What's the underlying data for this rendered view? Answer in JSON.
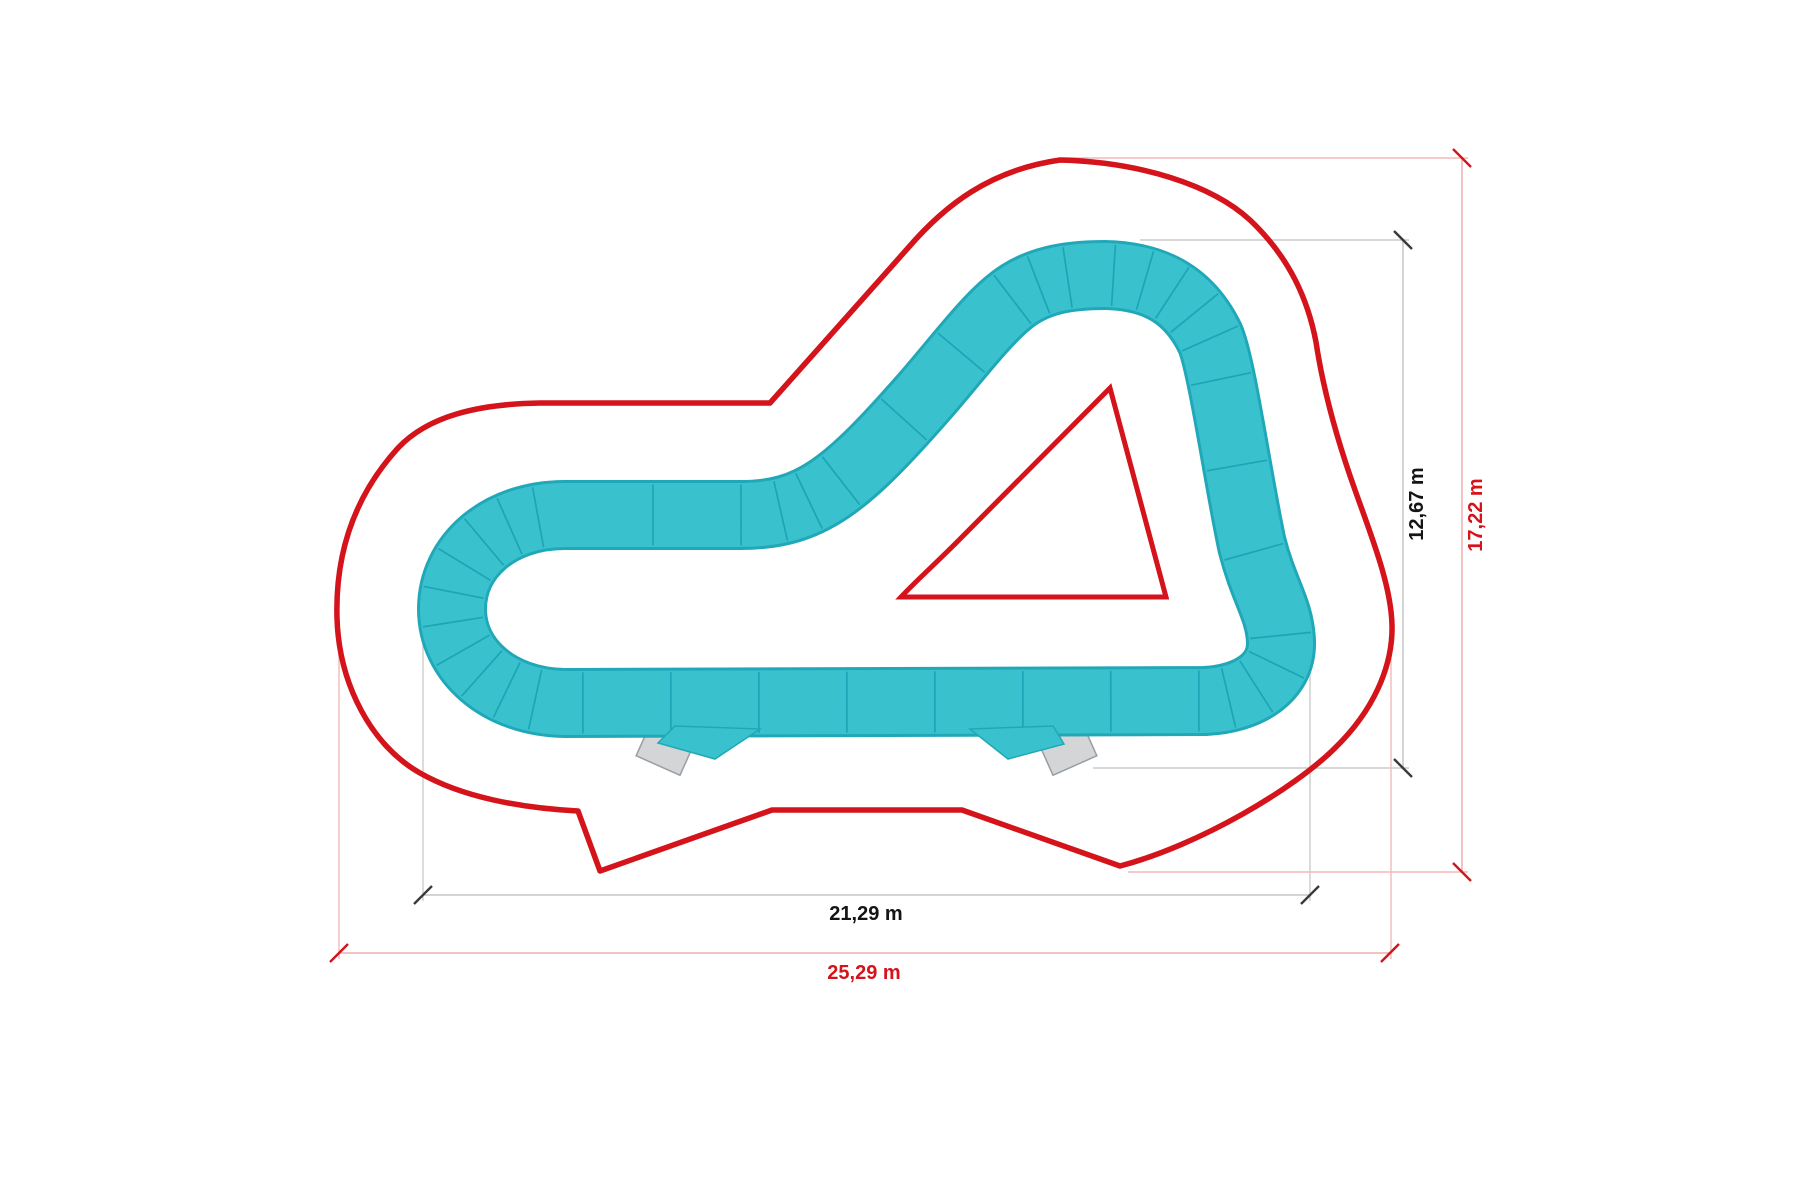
{
  "diagram": {
    "title": "pump-track-plan",
    "dimensions": {
      "track_width_label": "21,29 m",
      "track_height_label": "12,67 m",
      "zone_width_label": "25,29 m",
      "zone_height_label": "17,22 m"
    },
    "colors": {
      "track_surface": "#39c2cd",
      "track_edge": "#21a8b8",
      "track_joint": "#17a0b2",
      "boundary_red": "#d4131b",
      "dimension_black": "#141414",
      "extension_gray": "#cccccc",
      "extension_pink": "#f2b9b7",
      "ramp_fill": "#d3d5d7",
      "background": "#ffffff"
    },
    "elements": {
      "safety_boundary": "safety-zone-outline",
      "track_loop": "pump-track-loop",
      "inner_triangle": "inner-safety-triangle",
      "ramp_left": "start-ramp-left",
      "ramp_right": "start-ramp-right"
    }
  }
}
